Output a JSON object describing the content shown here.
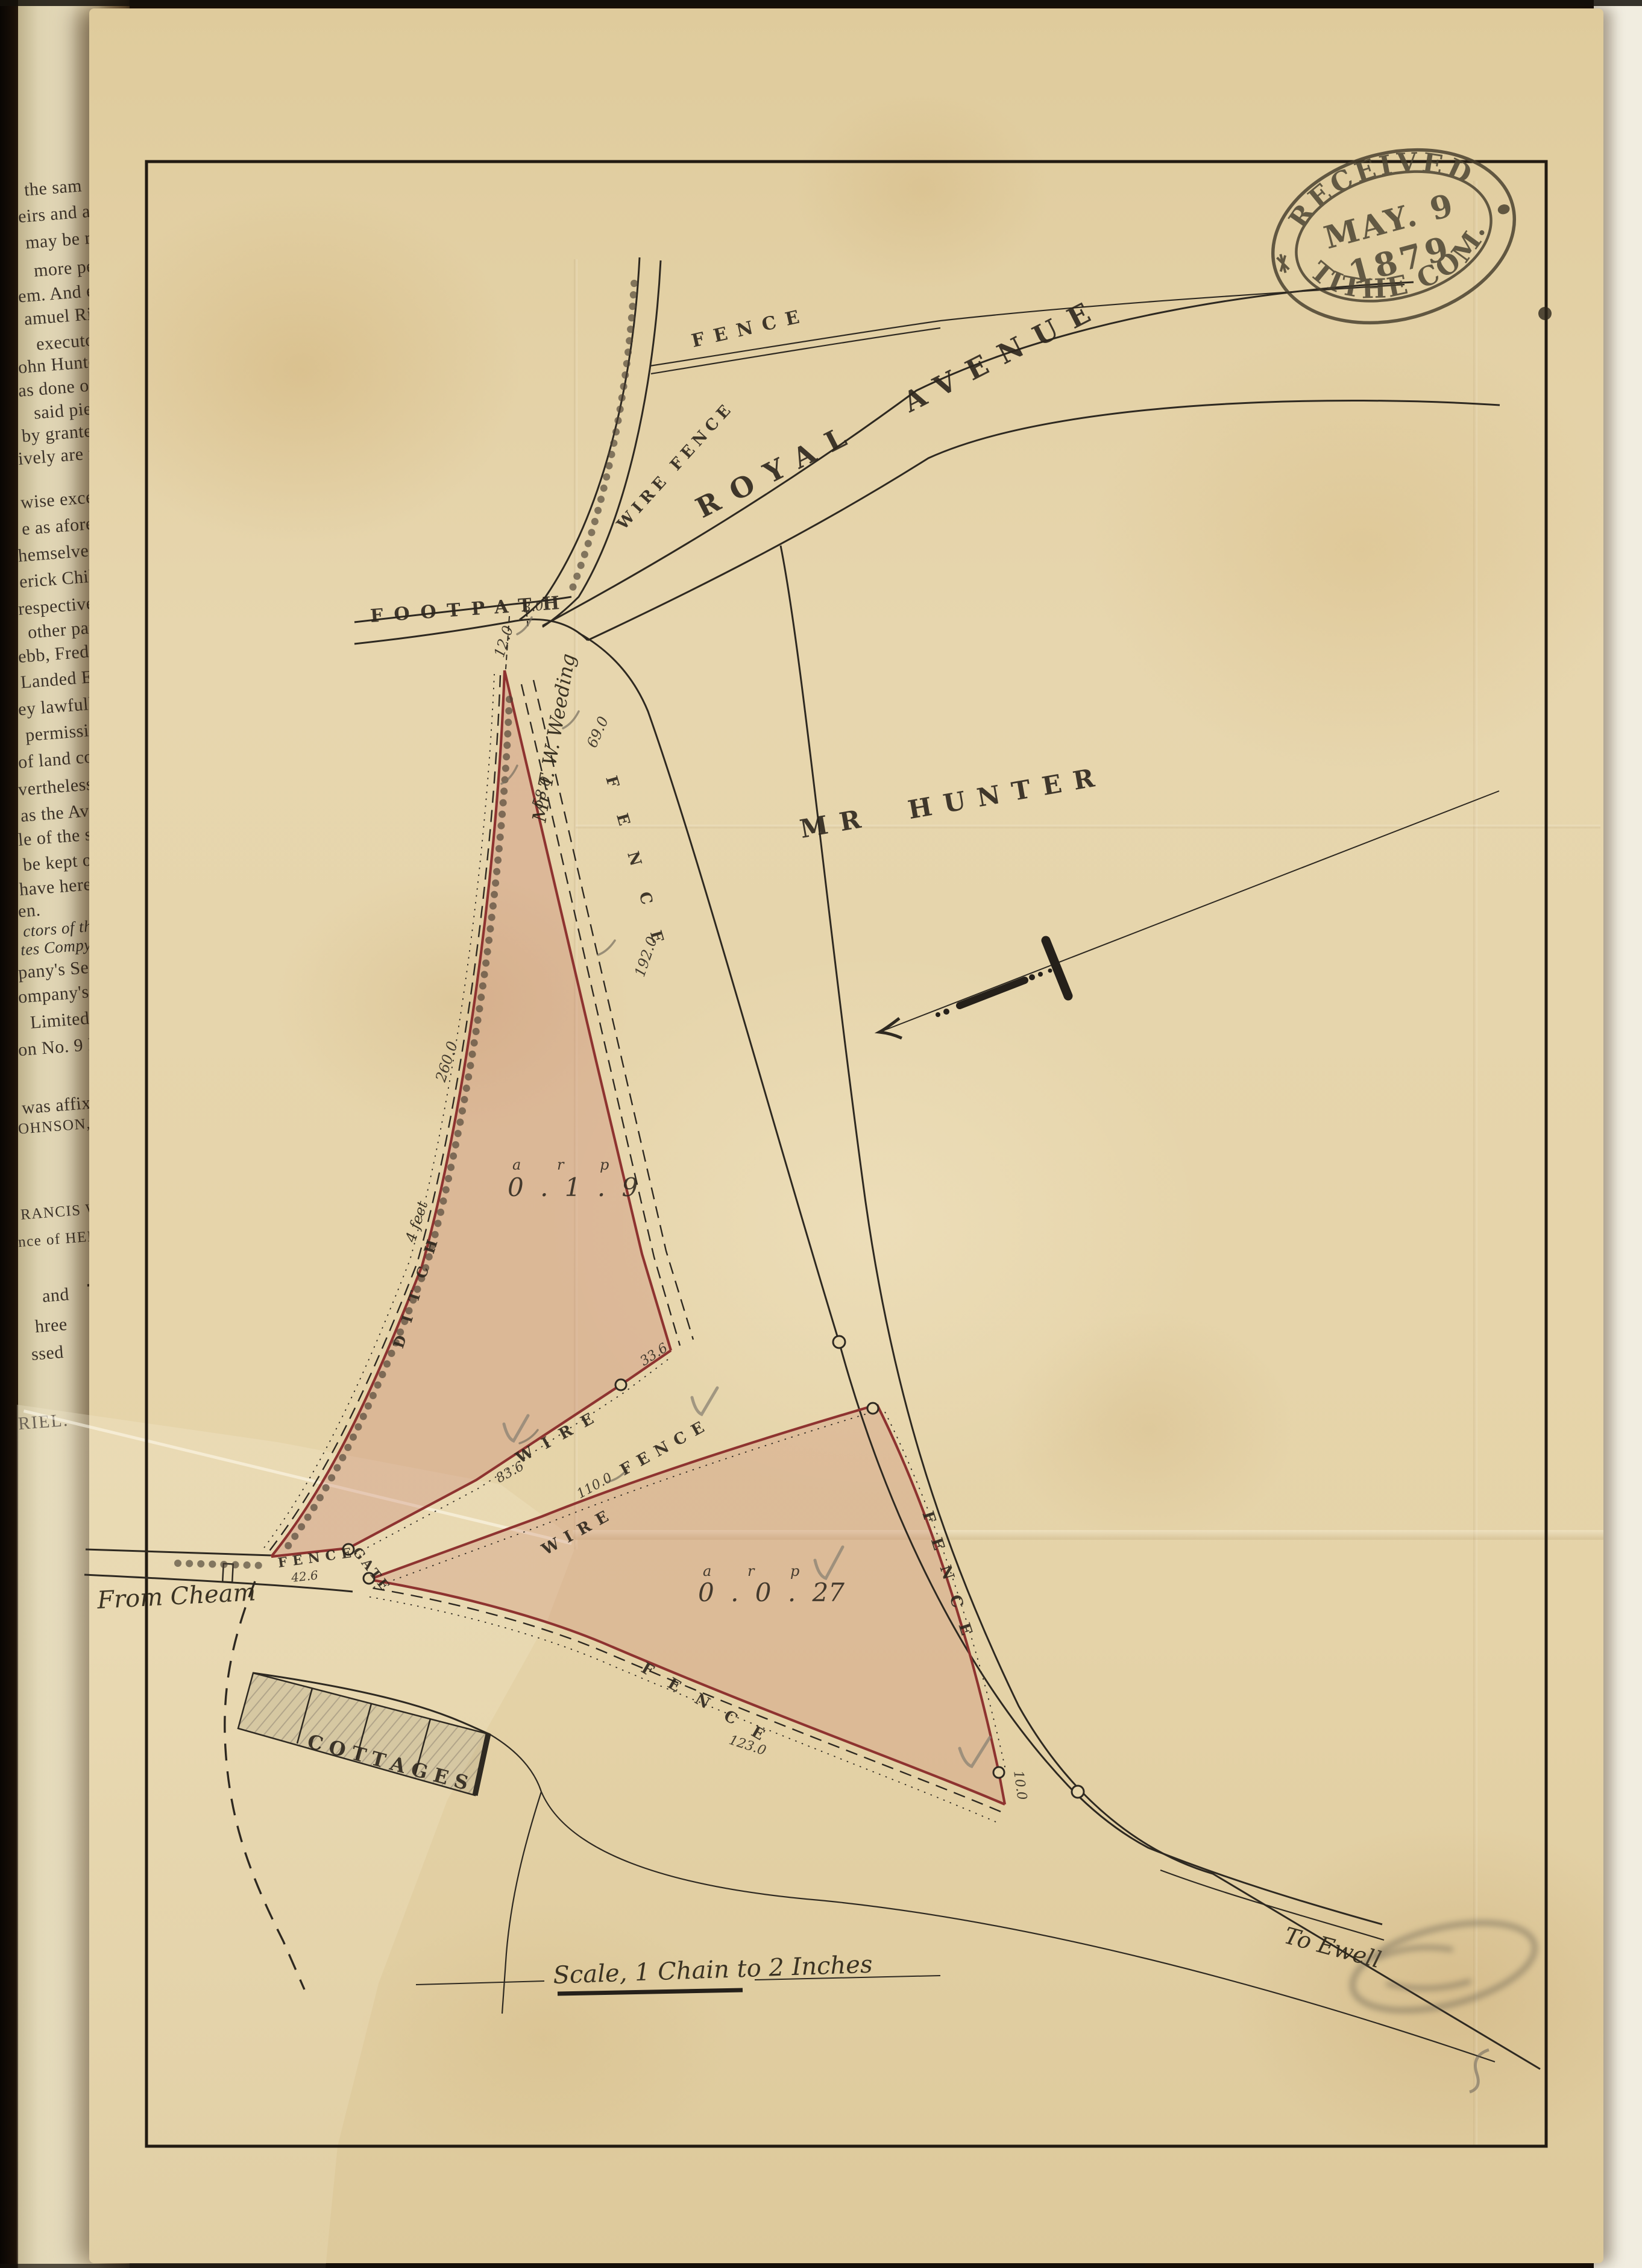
{
  "stamp": {
    "line1": "RECEIVED",
    "line2": "MAY. 9",
    "line3": "1879",
    "line4": "TITHE COM."
  },
  "map": {
    "roads": {
      "royal_avenue": "ROYAL AVENUE",
      "footpath": "FOOTPATH",
      "from_cheam": "From Cheam",
      "to_ewell": "To Ewell"
    },
    "labels": {
      "fence": "FENCE",
      "wire_fence": "WIRE FENCE",
      "wire": "WIRE",
      "ditch": "DITCH",
      "ditch_width": "4 feet",
      "gate": "GATE",
      "cottages": "COTTAGES",
      "mr_hunter": "MR HUNTER",
      "weeding": "Mr T. W. Weeding"
    },
    "scale_note": "Scale, 1 Chain to 2 Inches",
    "area_units": "a r p",
    "parcels": [
      {
        "area": "0 . 1 . 9"
      },
      {
        "area": "0 . 0 . 27"
      }
    ],
    "measurements": {
      "m8": "8.0",
      "m12": "12.0",
      "m33": "33.6",
      "m42": "42.6",
      "m58": "58.0",
      "m69": "69.0",
      "m83": "83.6",
      "m110": "110.0",
      "m123": "123.0",
      "m10": "10.0",
      "m192": "192.0",
      "m260": "260.0"
    }
  },
  "book_page": {
    "lines": [
      "the sam",
      "eirs and as",
      "may be req",
      "more perf",
      "em. And ea",
      "amuel Ric",
      "executors",
      "ohn Hunte",
      "as done or b",
      "said piece",
      "by granted",
      "ively are i",
      "wise excep",
      "e as afores",
      "hemselves t",
      "erick Chil",
      "respective h",
      "other part",
      "ebb, Frede",
      "Landed Est",
      "ey lawfully",
      "permission",
      "of land col",
      "vertheless t",
      "as the Ave",
      "le of the s",
      "be kept o",
      "have hereu",
      "en.",
      "ctors of the s",
      "tes Compy",
      "pany's Sea",
      "ompany's S",
      "Limited",
      "on No. 9 N",
      "was affixed",
      "OHNSON, N",
      "RANCIS WE",
      "nce of HEN",
      "and",
      "hree",
      "ssed",
      "RIEL."
    ],
    "brace": "}",
    "amount": "£30"
  }
}
